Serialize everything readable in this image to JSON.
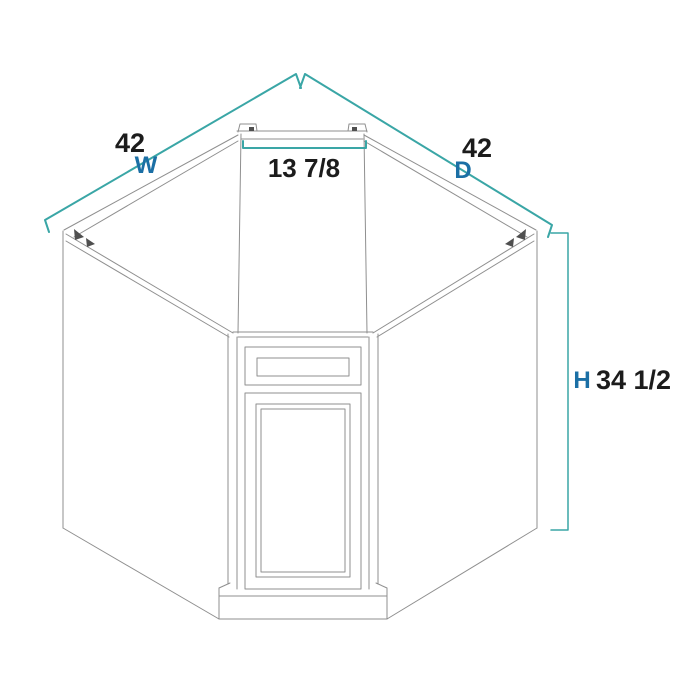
{
  "colors": {
    "background": "#ffffff",
    "cabinet_line": "#8f8f8f",
    "detail_dark": "#4f4f4f",
    "dimension_line": "#3aa6a6",
    "number_text": "#1c1c1c",
    "letter_text": "#1b6fa5"
  },
  "dimensions": {
    "width": {
      "value": "42",
      "letter": "W"
    },
    "depth": {
      "value": "42",
      "letter": "D"
    },
    "front_width": {
      "value": "13 7/8"
    },
    "height": {
      "value": "34 1/2",
      "letter": "H"
    }
  }
}
